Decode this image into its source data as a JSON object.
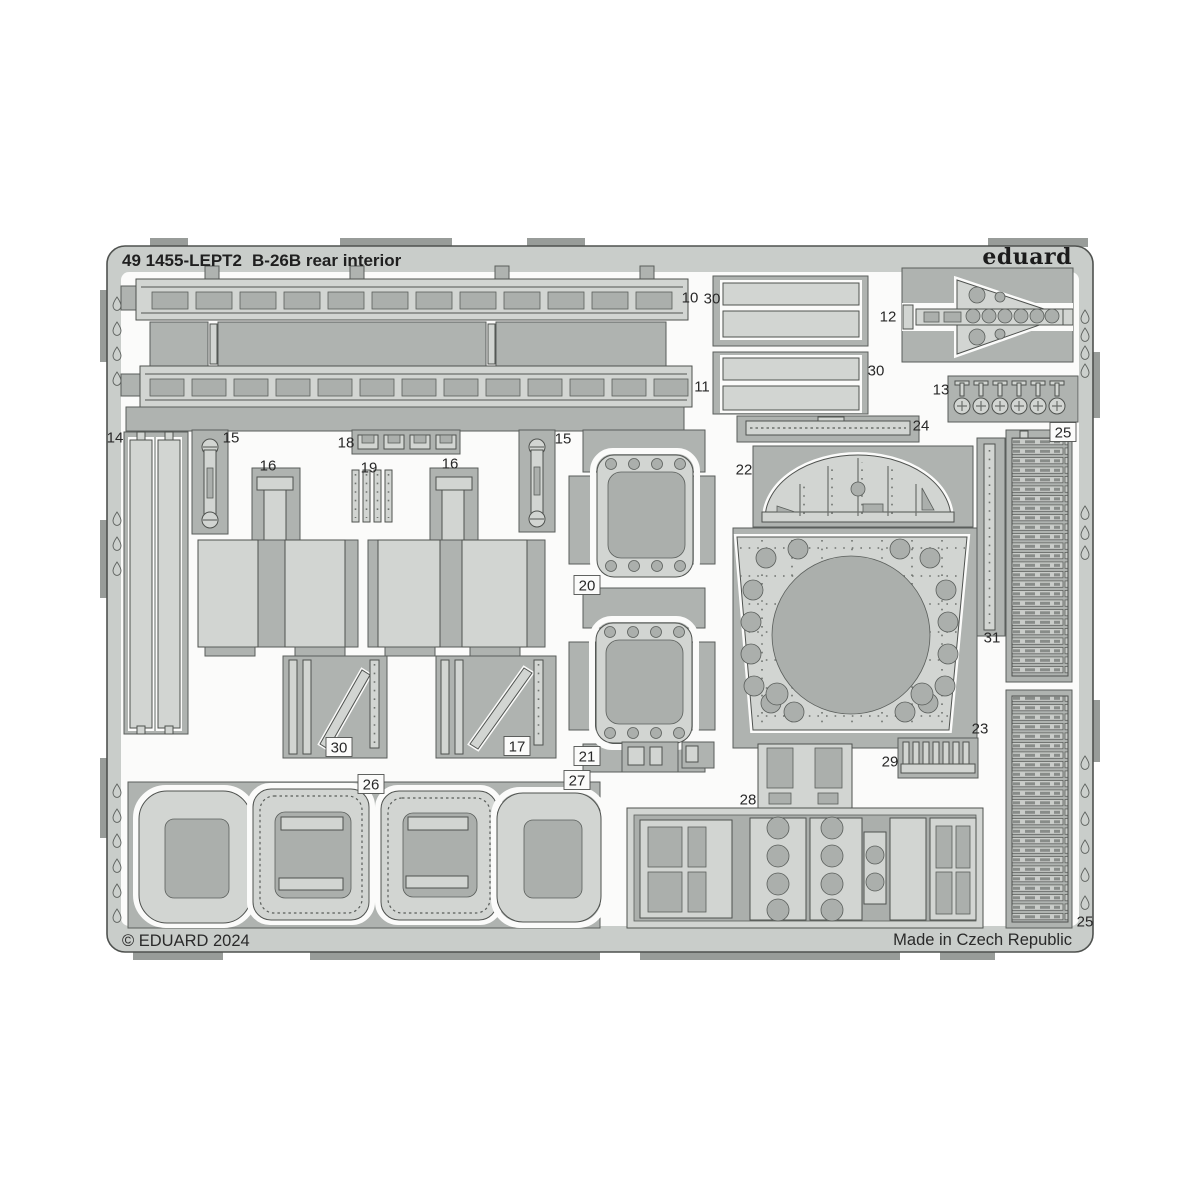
{
  "header": {
    "sheet_code": "49 1455-LEPT2",
    "sheet_name": "B-26B rear interior",
    "brand": "eduard"
  },
  "footer": {
    "copyright": "© EDUARD 2024",
    "made_in": "Made in Czech Republic"
  },
  "colors": {
    "background": "#ffffff",
    "sheet": "#c9cdca",
    "web": "#afb3b0",
    "part": "#d2d5d2",
    "hole": "#abafac",
    "outline": "#4f524f",
    "text": "#1f1f1f"
  },
  "part_labels": [
    {
      "id": "10",
      "x": 690,
      "y": 297,
      "box": false
    },
    {
      "id": "30",
      "x": 712,
      "y": 298,
      "box": false
    },
    {
      "id": "12",
      "x": 888,
      "y": 316,
      "box": false
    },
    {
      "id": "11",
      "x": 702,
      "y": 386,
      "box": false
    },
    {
      "id": "30",
      "x": 876,
      "y": 370,
      "box": false
    },
    {
      "id": "13",
      "x": 941,
      "y": 389,
      "box": false
    },
    {
      "id": "24",
      "x": 921,
      "y": 425,
      "box": false
    },
    {
      "id": "25",
      "x": 1063,
      "y": 432,
      "box": true
    },
    {
      "id": "14",
      "x": 115,
      "y": 437,
      "box": false
    },
    {
      "id": "15",
      "x": 231,
      "y": 437,
      "box": false
    },
    {
      "id": "16",
      "x": 268,
      "y": 465,
      "box": false
    },
    {
      "id": "18",
      "x": 346,
      "y": 442,
      "box": false
    },
    {
      "id": "19",
      "x": 369,
      "y": 467,
      "box": false
    },
    {
      "id": "16",
      "x": 450,
      "y": 463,
      "box": false
    },
    {
      "id": "15",
      "x": 563,
      "y": 438,
      "box": false
    },
    {
      "id": "22",
      "x": 744,
      "y": 469,
      "box": false
    },
    {
      "id": "20",
      "x": 587,
      "y": 585,
      "box": true
    },
    {
      "id": "31",
      "x": 992,
      "y": 637,
      "box": false
    },
    {
      "id": "30",
      "x": 339,
      "y": 747,
      "box": true
    },
    {
      "id": "17",
      "x": 517,
      "y": 746,
      "box": true
    },
    {
      "id": "23",
      "x": 980,
      "y": 728,
      "box": false
    },
    {
      "id": "21",
      "x": 587,
      "y": 756,
      "box": true
    },
    {
      "id": "29",
      "x": 890,
      "y": 761,
      "box": false
    },
    {
      "id": "26",
      "x": 371,
      "y": 784,
      "box": true
    },
    {
      "id": "27",
      "x": 577,
      "y": 780,
      "box": true
    },
    {
      "id": "28",
      "x": 748,
      "y": 799,
      "box": false
    },
    {
      "id": "25",
      "x": 1085,
      "y": 921,
      "box": false
    }
  ]
}
